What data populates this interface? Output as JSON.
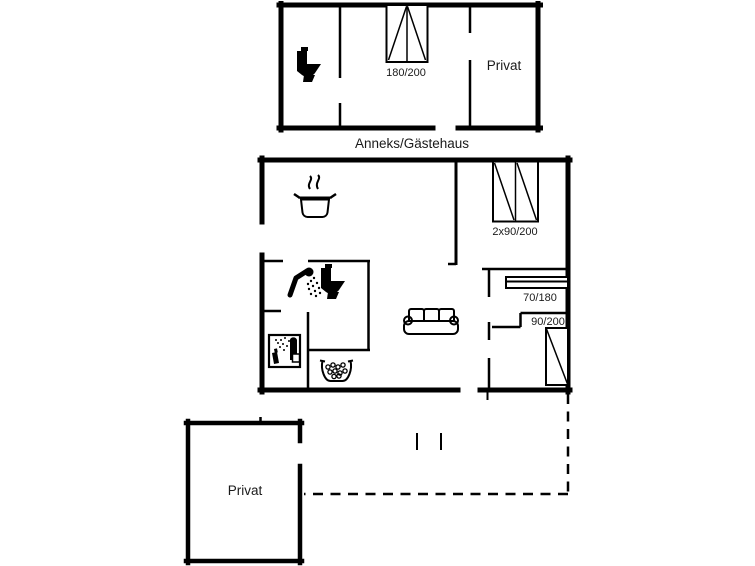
{
  "page": {
    "background": "#ffffff",
    "line_color": "#000000",
    "text_color": "#1a1a1a"
  },
  "annex": {
    "caption": "Anneks/Gästehaus",
    "privat_label": "Privat",
    "bed_size_label": "180/200"
  },
  "main_house": {
    "double_bed_label": "2x90/200",
    "bunk_bed_label": "70/180",
    "single_bed_label": "90/200"
  },
  "outbuilding": {
    "privat_label": "Privat"
  },
  "icons": [
    "toilet-icon",
    "double-bed-icon",
    "cooking-pot-icon",
    "shower-icon",
    "washing-machine-icon",
    "sink-icon",
    "sofa-icon",
    "bunk-bed-icon",
    "single-bed-icon"
  ]
}
